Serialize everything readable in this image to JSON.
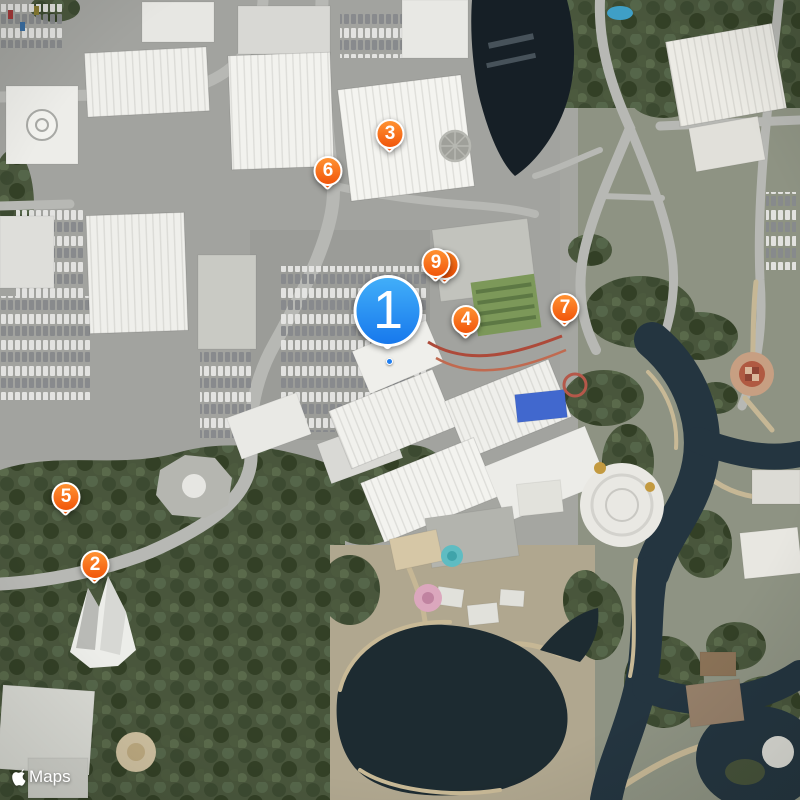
{
  "map": {
    "type": "satellite",
    "markers": {
      "primary": {
        "label": "1",
        "x": 388,
        "y": 311
      },
      "secondary": [
        {
          "label": "2",
          "x": 95,
          "y": 565
        },
        {
          "label": "3",
          "x": 390,
          "y": 134
        },
        {
          "label": "4",
          "x": 466,
          "y": 320
        },
        {
          "label": "5",
          "x": 66,
          "y": 497
        },
        {
          "label": "6",
          "x": 328,
          "y": 171
        },
        {
          "label": "7",
          "x": 565,
          "y": 308
        },
        {
          "label": "9",
          "x": 436,
          "y": 263,
          "has_stacked_pin_behind": true
        }
      ]
    },
    "location_dot": {
      "x": 389,
      "y": 361
    },
    "colors": {
      "primary_pin_top": "#41aef9",
      "primary_pin_bottom": "#1778ec",
      "secondary_pin_top": "#ff9232",
      "secondary_pin_bottom": "#f1560b",
      "pin_border": "#ffffff",
      "water": "#1d2831",
      "trees": "#49563c"
    }
  },
  "attribution": {
    "logo": "apple-logo",
    "label": "Maps"
  }
}
